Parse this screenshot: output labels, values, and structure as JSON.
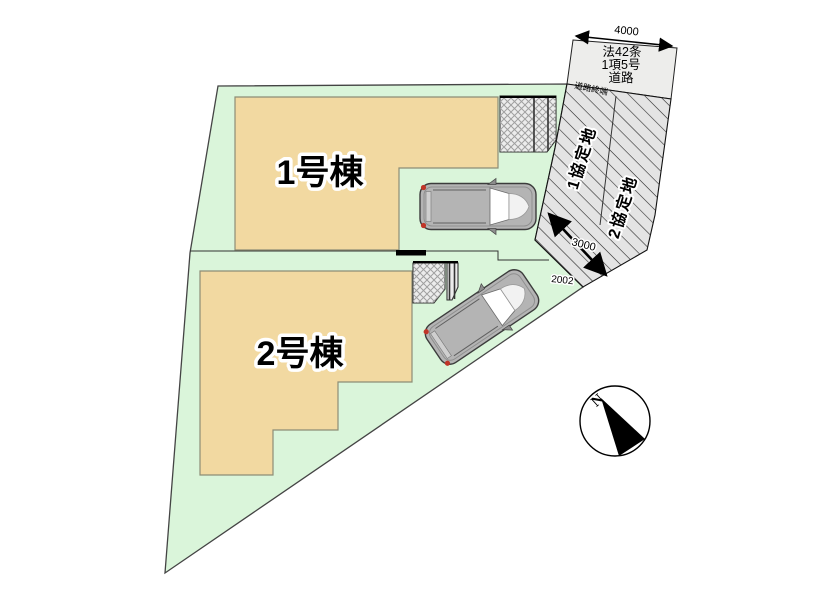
{
  "plan": {
    "buildings": {
      "b1": "1号棟",
      "b2": "2号棟"
    },
    "road_sign": {
      "line1": "法42条",
      "line2": "1項5号",
      "line3": "道路"
    },
    "annotations": {
      "road_end": "道路終端",
      "agreement1": "1協定地",
      "agreement2": "2協定地",
      "north": "N"
    },
    "dimensions": {
      "top_road_width": "4000",
      "mid_road_width": "3000",
      "side_boundary": "2002"
    }
  },
  "colors": {
    "site": "#daf5da",
    "building": "#f2d9a1",
    "road_box": "#ededeb",
    "hatch_area": "#e4e4e4",
    "patch": "#ececec",
    "car_body": "#b4b4b4",
    "black": "#000000"
  }
}
